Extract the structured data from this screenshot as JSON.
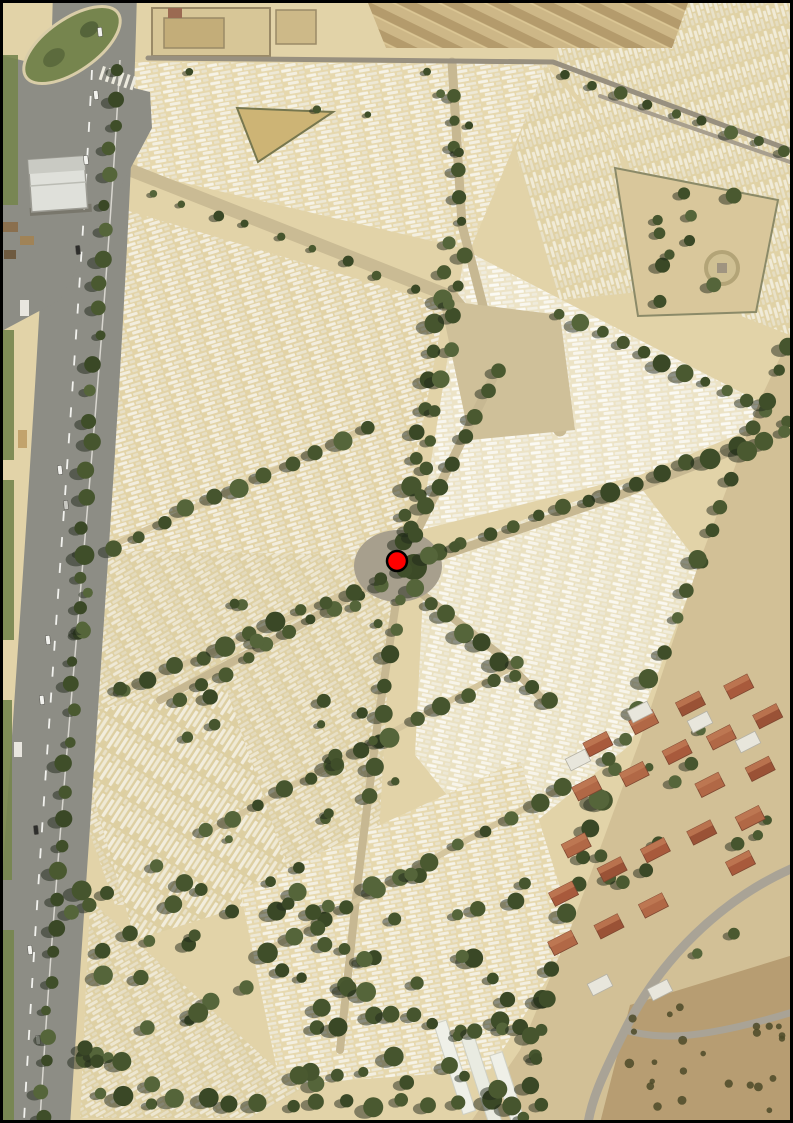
{
  "window": {
    "width": 793,
    "height": 1123,
    "background": "#ffffff",
    "frame_border_color": "#000000"
  },
  "map": {
    "kind": "aerial-satellite-imagery",
    "scene_description": "Aerial photograph of a large cemetery: dense rows of white tombs on tan ground, tree-lined avenues radiating from a central roundabout plaza, a gray boulevard with a landscaped traffic island in the northwest, a perimeter wall along the north, a garden plot with a circular path in the northeast, red-tile-roofed houses and open bare ground in the southeast, dense trees in the south",
    "marker": {
      "cx": 397,
      "cy": 561,
      "r": 10,
      "fill": "#ff0000",
      "stroke": "#000000",
      "stroke_width": 2.5
    }
  },
  "palette": {
    "ground_tan": "#e2d3a8",
    "tomb_white": "#f5f2e6",
    "avenue_tan": "#cabb94",
    "road_gray": "#8d8d85",
    "roundabout_gray": "#a79f8d",
    "tree_green": "#46552e",
    "tree_shadow": "#20271a",
    "grass_green": "#76854e",
    "open_ground": "#d2c096",
    "bare_earth_brown": "#b79d72",
    "roof_terracotta": "#a85a3c",
    "wall_gray": "#98907f",
    "building_roof_white": "#e3e3de"
  },
  "features": [
    "boulevard-west",
    "traffic-island-northwest",
    "cemetery-tomb-blocks",
    "central-roundabout",
    "location-marker",
    "tree-lined-avenues",
    "perimeter-wall-north",
    "garden-plot-northeast",
    "circular-path-feature",
    "houses-southeast",
    "open-ground-southeast",
    "forest-area-south"
  ]
}
